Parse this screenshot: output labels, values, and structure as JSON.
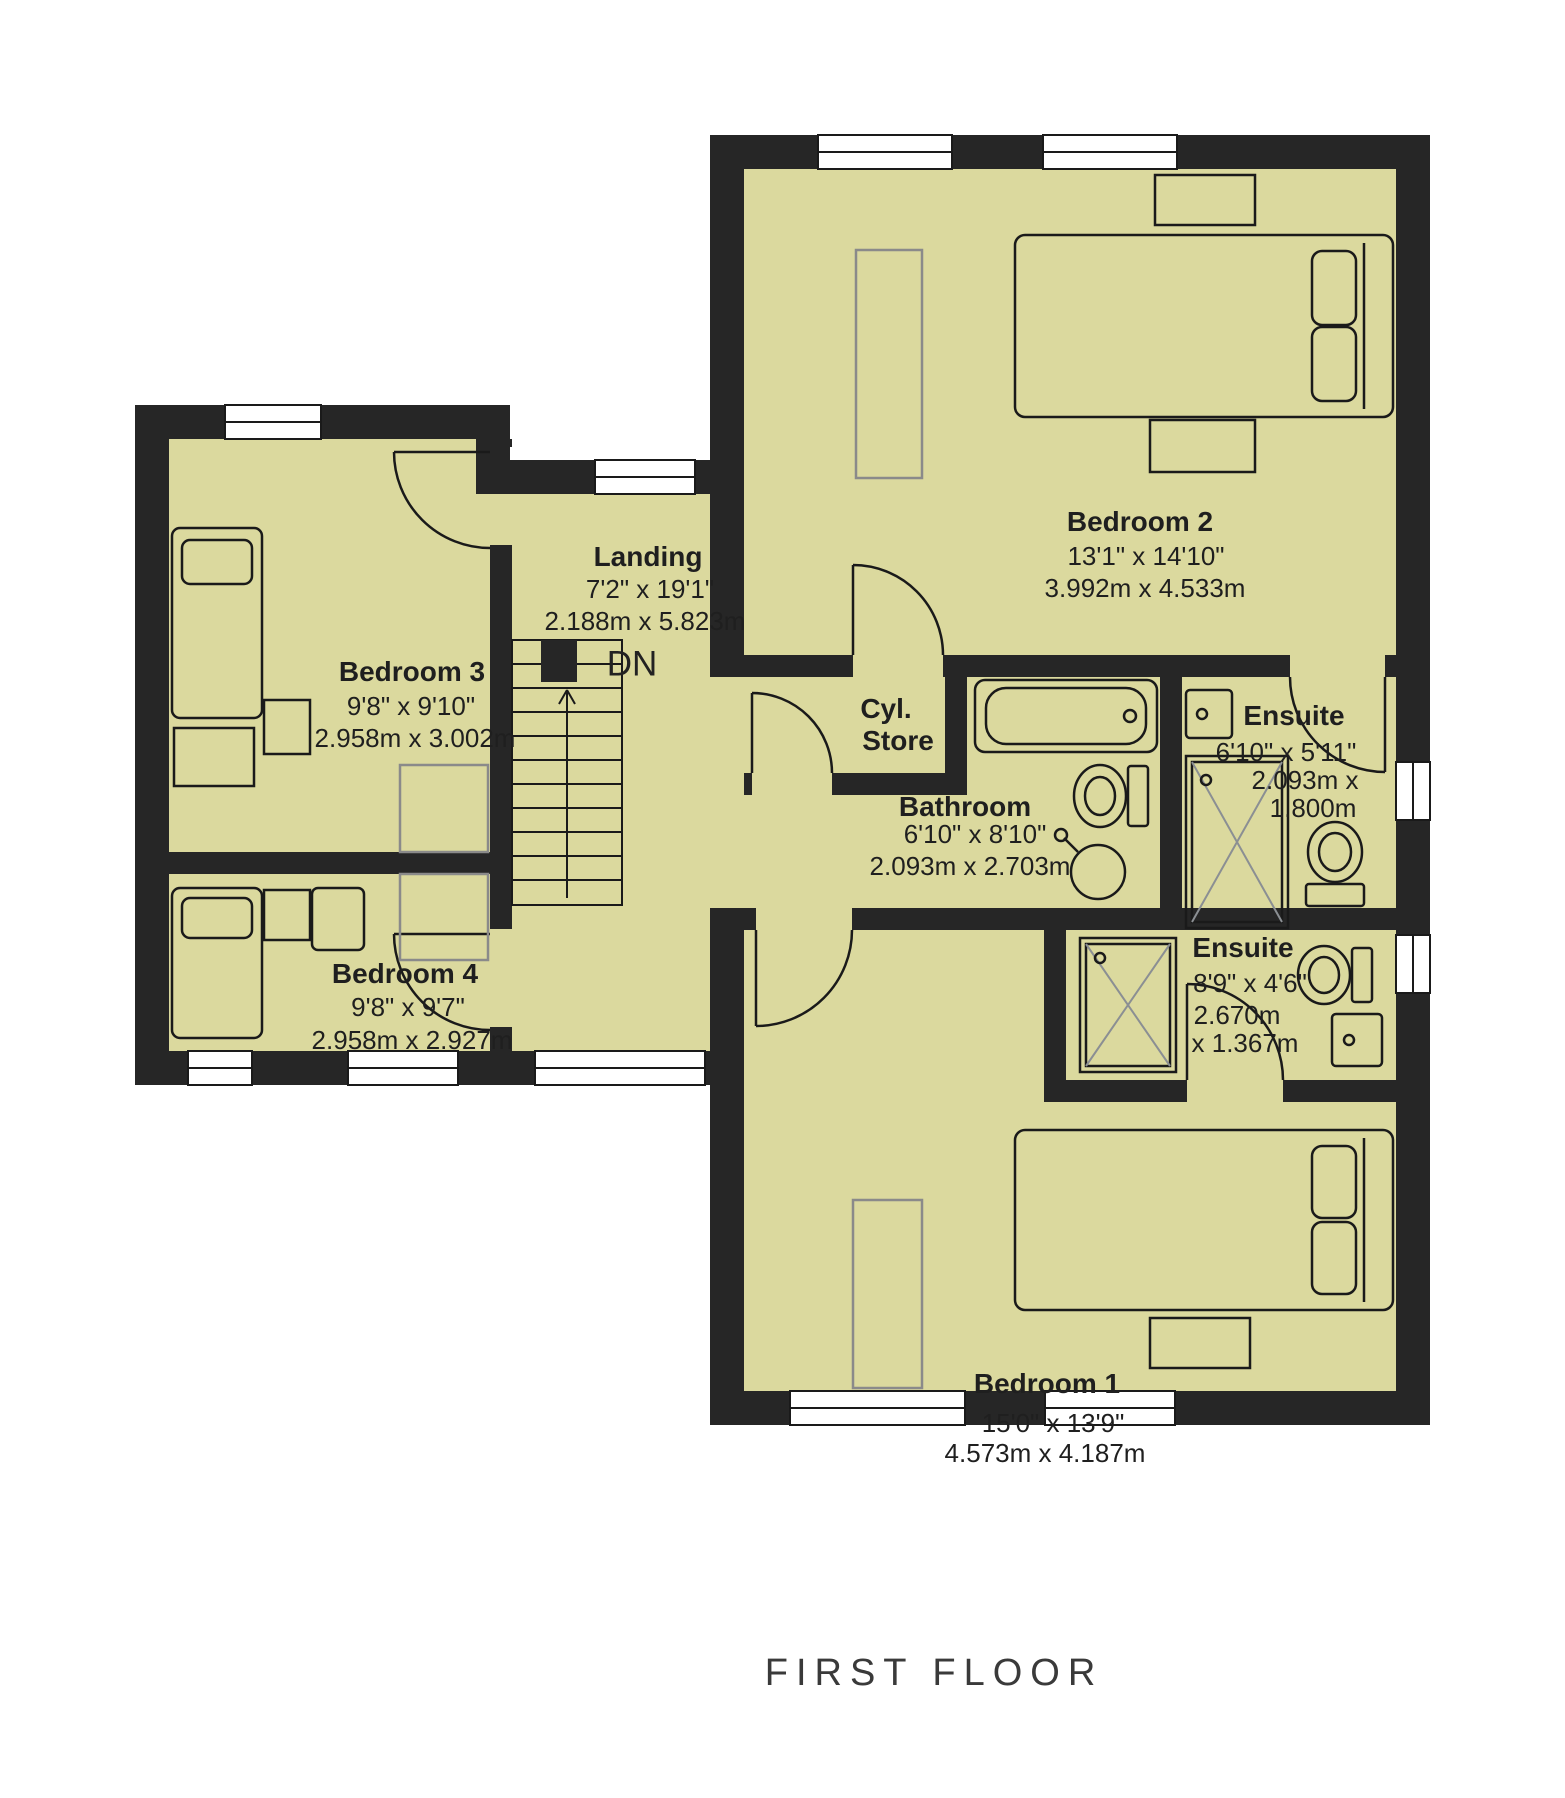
{
  "plan": {
    "title": "FIRST FLOOR",
    "stairs_label": "DN"
  },
  "rooms": {
    "bedroom1": {
      "name": "Bedroom 1",
      "imperial": "15'0\" x 13'9\"",
      "metric": "4.573m x 4.187m"
    },
    "bedroom2": {
      "name": "Bedroom 2",
      "imperial": "13'1\" x 14'10\"",
      "metric": "3.992m x 4.533m"
    },
    "bedroom3": {
      "name": "Bedroom 3",
      "imperial": "9'8\" x 9'10\"",
      "metric": "2.958m x 3.002m"
    },
    "bedroom4": {
      "name": "Bedroom 4",
      "imperial": "9'8\" x 9'7\"",
      "metric": "2.958m x 2.927m"
    },
    "landing": {
      "name": "Landing",
      "imperial": "7'2\" x 19'1\"",
      "metric": "2.188m x 5.823m"
    },
    "bathroom": {
      "name": "Bathroom",
      "imperial": "6'10\" x 8'10\"",
      "metric": "2.093m x 2.703m"
    },
    "cyl_store": {
      "name_line1": "Cyl.",
      "name_line2": "Store"
    },
    "ensuite_top": {
      "name": "Ensuite",
      "imperial": "6'10\" x 5'11\"",
      "metric_line1": "2.093m x",
      "metric_line2": "1.800m"
    },
    "ensuite_bottom": {
      "name": "Ensuite",
      "imperial": "8'9\" x 4'6\"",
      "metric_line1": "2.670m",
      "metric_line2": "x 1.367m"
    }
  },
  "colors": {
    "wall": "#262626",
    "room_fill": "#dbd99e",
    "fixture_line": "#1a1a1a",
    "furniture_gray": "#8a8a8a",
    "text": "#1f1f1f",
    "title_text": "#3a3a3a"
  }
}
